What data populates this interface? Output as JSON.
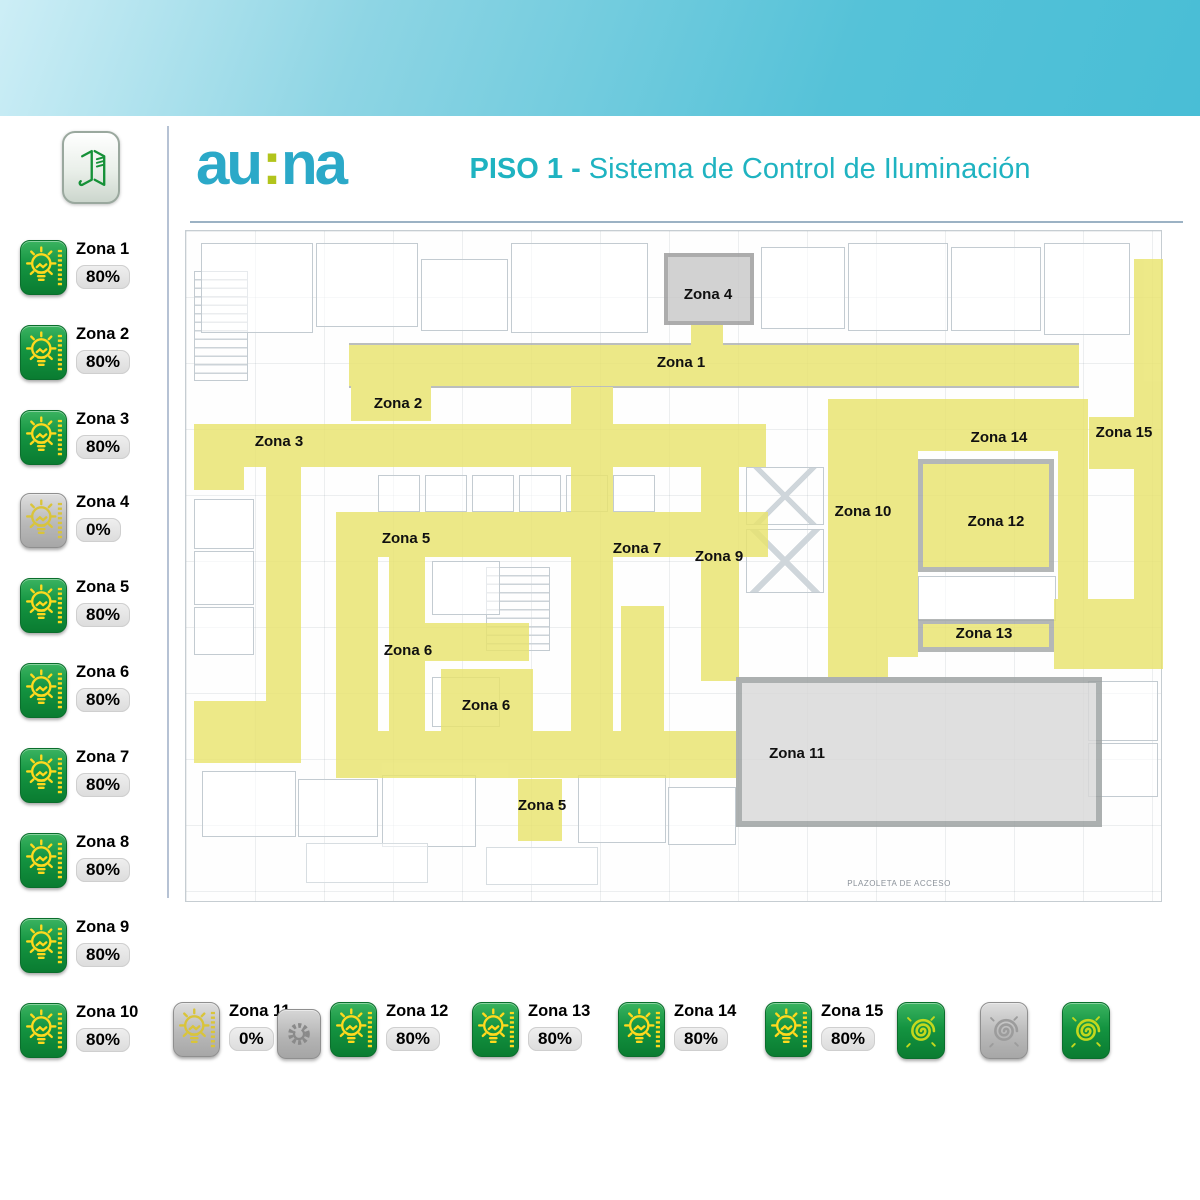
{
  "header": {
    "logo_part1": "au",
    "logo_colon": ":",
    "logo_part2": "na",
    "title_bold": "PISO 1 - ",
    "title_rest": "Sistema de Control de Iluminación"
  },
  "sidebar_zones": [
    {
      "label": "Zona 1",
      "value": "80%",
      "state": "on"
    },
    {
      "label": "Zona 2",
      "value": "80%",
      "state": "on"
    },
    {
      "label": "Zona 3",
      "value": "80%",
      "state": "on"
    },
    {
      "label": "Zona 4",
      "value": "0%",
      "state": "off"
    },
    {
      "label": "Zona 5",
      "value": "80%",
      "state": "on"
    },
    {
      "label": "Zona 6",
      "value": "80%",
      "state": "on"
    },
    {
      "label": "Zona 7",
      "value": "80%",
      "state": "on"
    },
    {
      "label": "Zona 8",
      "value": "80%",
      "state": "on"
    },
    {
      "label": "Zona 9",
      "value": "80%",
      "state": "on"
    },
    {
      "label": "Zona 10",
      "value": "80%",
      "state": "on"
    }
  ],
  "bottom_zones": [
    {
      "label": "Zona 11",
      "value": "0%",
      "state": "off"
    },
    {
      "label": "Zona 12",
      "value": "80%",
      "state": "on"
    },
    {
      "label": "Zona 13",
      "value": "80%",
      "state": "on"
    },
    {
      "label": "Zona 14",
      "value": "80%",
      "state": "on"
    },
    {
      "label": "Zona 15",
      "value": "80%",
      "state": "on"
    }
  ],
  "scene_buttons": [
    {
      "name": "scene-all-on-1",
      "state": "on"
    },
    {
      "name": "scene-all-off",
      "state": "off"
    },
    {
      "name": "scene-all-on-2",
      "state": "on"
    }
  ],
  "plan": {
    "labels": [
      "Zona 4",
      "Zona 1",
      "Zona 2",
      "Zona 3",
      "Zona 14",
      "Zona 15",
      "Zona 5",
      "Zona 7",
      "Zona 9",
      "Zona 10",
      "Zona 12",
      "Zona 6",
      "Zona 13",
      "Zona 6",
      "Zona 11",
      "Zona 5",
      "PLAZOLETA DE ACCESO"
    ]
  },
  "colors": {
    "accent_teal": "#1fb3c1",
    "logo_teal": "#2ba9c8",
    "logo_lime": "#b2c41c",
    "zone_on_green": "#149441",
    "zone_off_gray": "#b9b9b9",
    "highlight_yellow": "#e9e46e",
    "bulb_yellow": "#ffd91e"
  }
}
